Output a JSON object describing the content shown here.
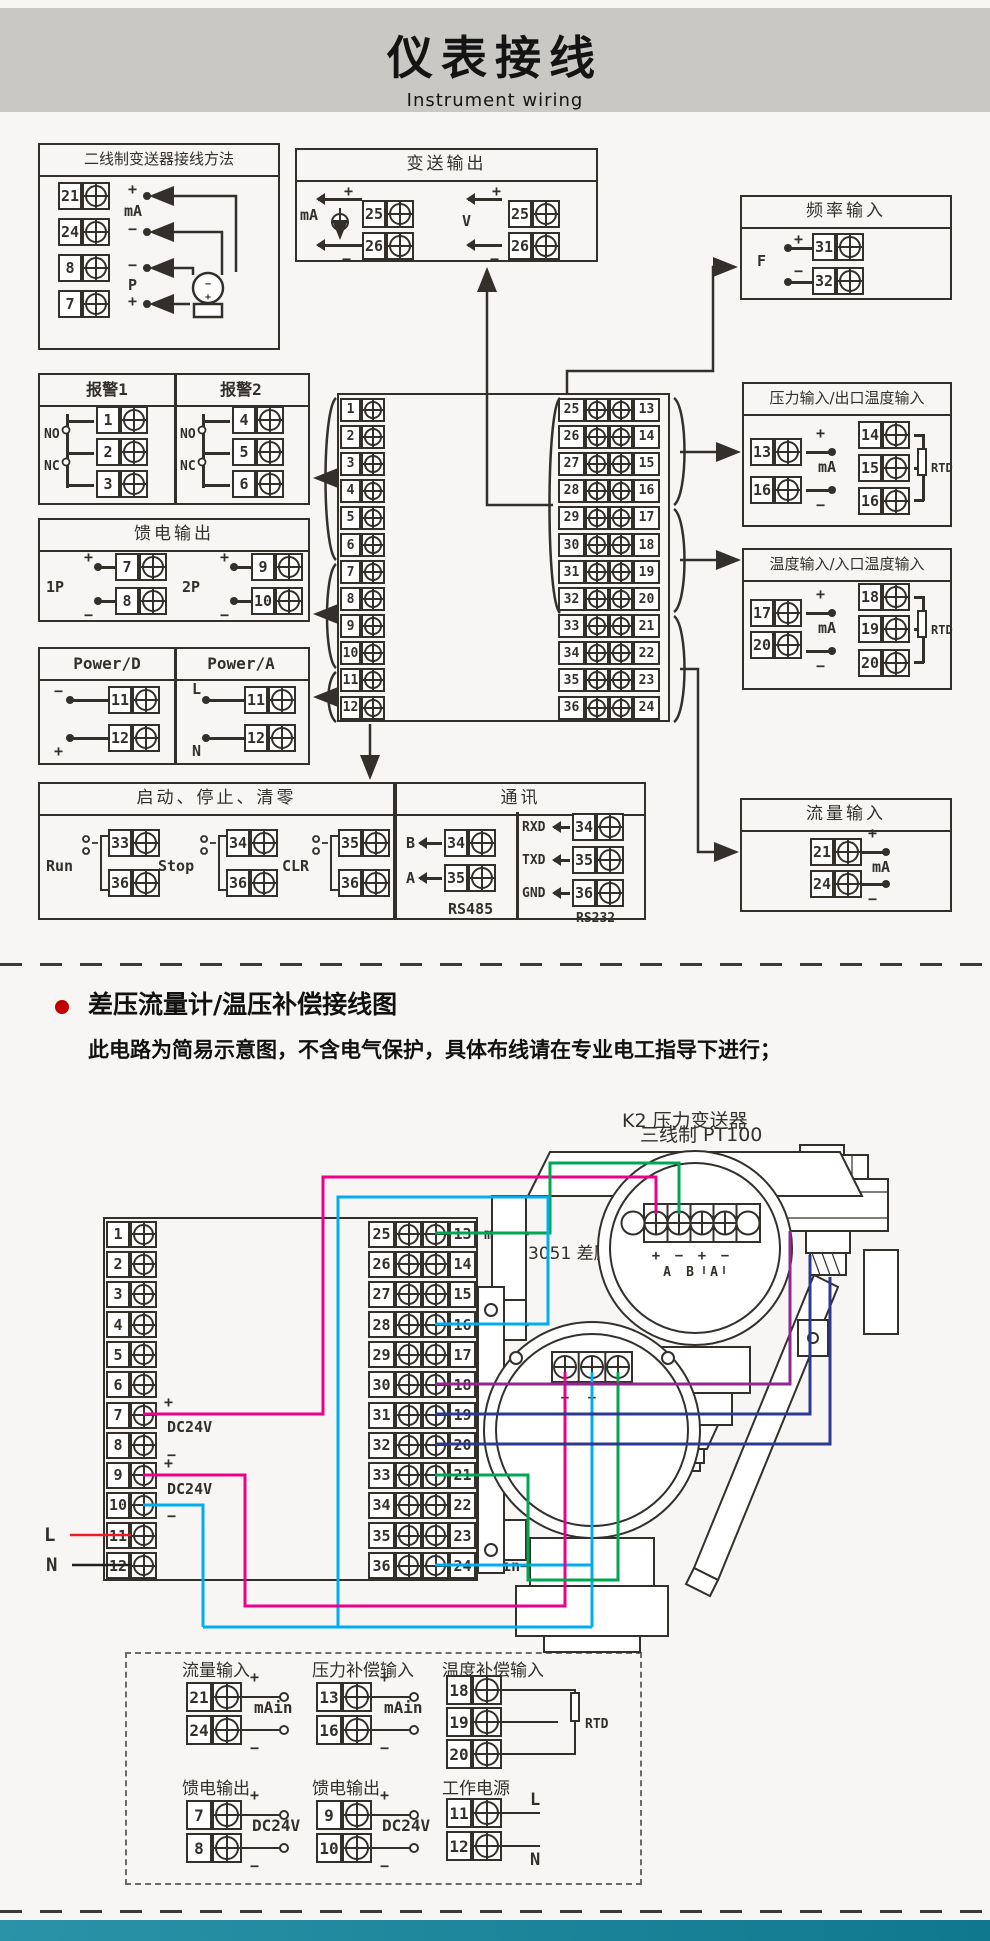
{
  "colors": {
    "ink": "#33302c",
    "band_gray": "#c9c8c5",
    "page_bg": "#f7f6f4",
    "footer_teal": "#1b86a0",
    "wire_magenta": "#ec008c",
    "wire_green": "#00a651",
    "wire_cyan": "#00aeef",
    "wire_purple": "#93268f",
    "wire_navy": "#2b3990",
    "wire_red": "#ed1c24",
    "wire_black": "#231f20",
    "bullet_red": "#c00000"
  },
  "header": {
    "title": "仪表接线",
    "subtitle": "Instrument wiring"
  },
  "shared": {
    "strip12": [
      1,
      2,
      3,
      4,
      5,
      6,
      7,
      8,
      9,
      10,
      11,
      12
    ],
    "pairs": [
      {
        "l": 25,
        "r": 13
      },
      {
        "l": 26,
        "r": 14
      },
      {
        "l": 27,
        "r": 15
      },
      {
        "l": 28,
        "r": 16
      },
      {
        "l": 29,
        "r": 17
      },
      {
        "l": 30,
        "r": 18
      },
      {
        "l": 31,
        "r": 19
      },
      {
        "l": 32,
        "r": 20
      },
      {
        "l": 33,
        "r": 21
      },
      {
        "l": 34,
        "r": 22
      },
      {
        "l": 35,
        "r": 23
      },
      {
        "l": 36,
        "r": 24
      }
    ]
  },
  "top": {
    "two_wire": {
      "title": "二线制变送器接线方法",
      "t": [
        21,
        24,
        8,
        7
      ],
      "signs": [
        "+",
        "mA",
        "−",
        "−",
        "P",
        "+"
      ],
      "tx": [
        "−",
        "+"
      ]
    },
    "transmit": {
      "title": "变送输出",
      "left_sig": "mA",
      "right_sig": "V",
      "plus": "+",
      "minus": "−",
      "lt": [
        25,
        26
      ],
      "rt": [
        25,
        26
      ]
    },
    "freq": {
      "title": "频率输入",
      "sig": "F",
      "plus": "+",
      "minus": "−",
      "t": [
        31,
        32
      ]
    },
    "alarm": {
      "t1": "报警1",
      "t2": "报警2",
      "no": "NO",
      "nc": "NC",
      "c1": [
        1,
        2,
        3
      ],
      "c2": [
        4,
        5,
        6
      ]
    },
    "feed": {
      "title": "馈电输出",
      "plus": "+",
      "minus": "−",
      "groups": [
        {
          "name": "1P",
          "p": 7,
          "m": 8
        },
        {
          "name": "2P",
          "p": 9,
          "m": 10
        }
      ]
    },
    "power": {
      "t1": "Power/D",
      "t2": "Power/A",
      "d": {
        "top": "−",
        "bot": "+",
        "t": [
          11,
          12
        ]
      },
      "a": {
        "top": "L",
        "bot": "N",
        "t": [
          11,
          12
        ]
      }
    },
    "runstop": {
      "title": "启动、停止、清零",
      "groups": [
        {
          "name": "Run",
          "a": 33,
          "b": 36
        },
        {
          "name": "Stop",
          "a": 34,
          "b": 36
        },
        {
          "name": "CLR",
          "a": 35,
          "b": 36
        }
      ]
    },
    "comm": {
      "title": "通讯",
      "rs485": {
        "label": "RS485",
        "rows": [
          {
            "s": "B",
            "n": 34
          },
          {
            "s": "A",
            "n": 35
          }
        ]
      },
      "rs232": {
        "label": "RS232",
        "rows": [
          {
            "s": "RXD",
            "n": 34
          },
          {
            "s": "TXD",
            "n": 35
          },
          {
            "s": "GND",
            "n": 36
          }
        ]
      }
    },
    "flow": {
      "title": "流量输入",
      "p": 21,
      "m": 24,
      "sig": "mA",
      "plus": "+",
      "minus": "−"
    },
    "pressure": {
      "title": "压力输入/出口温度输入",
      "p": 13,
      "m": 16,
      "sig": "mA",
      "plus": "+",
      "minus": "−",
      "rtd_t": [
        14,
        15,
        16
      ],
      "rtd": "RTD"
    },
    "temp": {
      "title": "温度输入/入口温度输入",
      "p": 17,
      "m": 20,
      "sig": "mA",
      "plus": "+",
      "minus": "−",
      "rtd_t": [
        18,
        19,
        20
      ],
      "rtd": "RTD"
    }
  },
  "bottom": {
    "heading": "差压流量计/温压补偿接线图",
    "note": "此电路为简易示意图，不含电气保护，具体布线请在专业电工指导下进行；",
    "k2_label": "K2 压力变送器",
    "k2_signs": [
      "+",
      "−",
      "+",
      "−"
    ],
    "k2_ports": [
      "A",
      "B",
      "A"
    ],
    "pt100_label": "三线制  PT100",
    "d3051_label": "3051 差压流量计",
    "d3051_signs": [
      "+",
      "−"
    ],
    "strip_rows": [
      {
        "l": 25,
        "r": 13,
        "lab": "mAin+"
      },
      {
        "l": 26,
        "r": 14
      },
      {
        "l": 27,
        "r": 15
      },
      {
        "l": 28,
        "r": 16,
        "lab": "mAin−"
      },
      {
        "l": 29,
        "r": 17
      },
      {
        "l": 30,
        "r": 18,
        "lab": "A"
      },
      {
        "l": 31,
        "r": 19,
        "lab": "B"
      },
      {
        "l": 32,
        "r": 20,
        "lab": "B"
      },
      {
        "l": 33,
        "r": 21,
        "lab": "mAin+"
      },
      {
        "l": 34,
        "r": 22
      },
      {
        "l": 35,
        "r": 23
      },
      {
        "l": 36,
        "r": 24,
        "lab": "mAin−"
      }
    ],
    "labels": {
      "plus": "+",
      "minus": "−",
      "dc": "DC24V",
      "l": "L",
      "n": "N"
    },
    "dashed": {
      "g1": {
        "title": "流量输入",
        "a": 21,
        "b": 24,
        "sig": "mAin",
        "plus": "+",
        "minus": "−"
      },
      "g2": {
        "title": "压力补偿输入",
        "a": 13,
        "b": 16,
        "sig": "mAin",
        "plus": "+",
        "minus": "−"
      },
      "g3": {
        "title": "温度补偿输入",
        "t": [
          18,
          19,
          20
        ],
        "sig": "RTD"
      },
      "g4": {
        "title": "馈电输出",
        "a": 7,
        "b": 8,
        "sig": "DC24V",
        "plus": "+",
        "minus": "−"
      },
      "g5": {
        "title": "馈电输出",
        "a": 9,
        "b": 10,
        "sig": "DC24V",
        "plus": "+",
        "minus": "−"
      },
      "g6": {
        "title": "工作电源",
        "a": 11,
        "b": 12,
        "l": "L",
        "n": "N"
      }
    }
  }
}
